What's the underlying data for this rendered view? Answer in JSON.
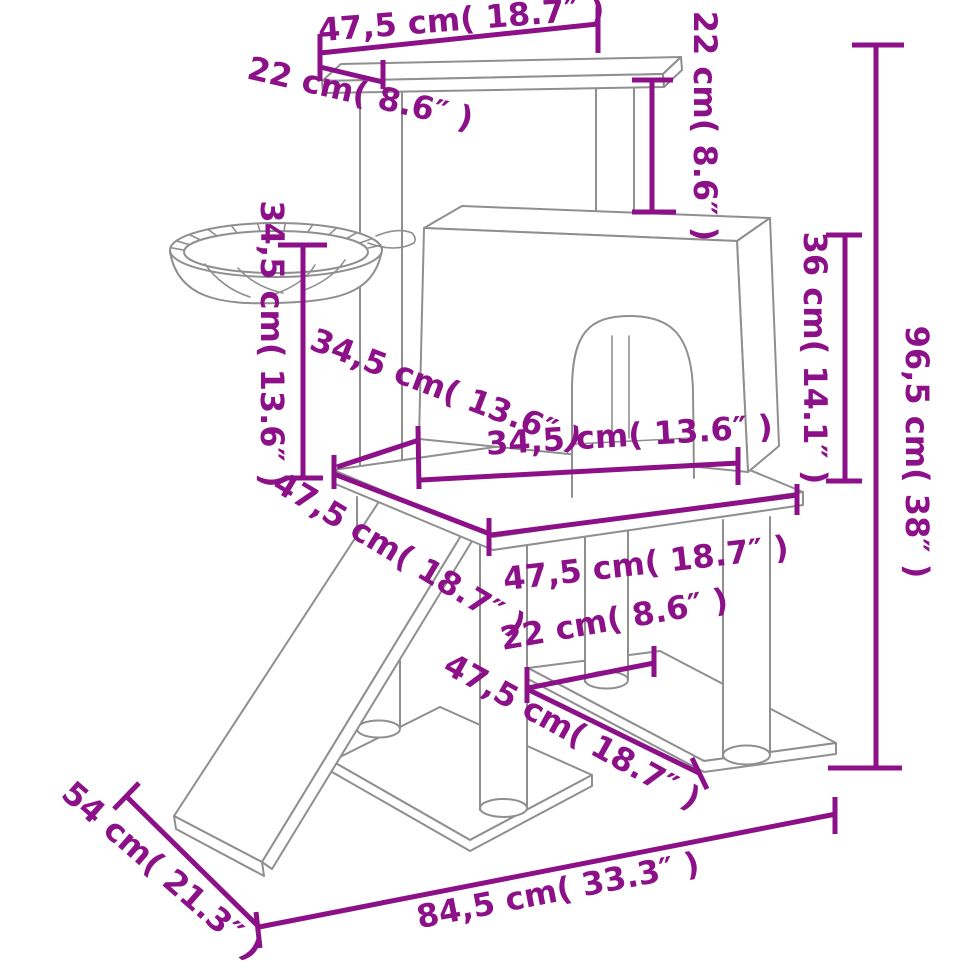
{
  "figure": {
    "type": "product-dimension-diagram",
    "subject": "cat-tree-with-scratching-posts-line-drawing",
    "parts": [
      "top-shelf",
      "support-posts",
      "hammock-basket",
      "cat-house-with-arch-door",
      "middle-platform",
      "ramp",
      "lower-shelf",
      "base-board"
    ]
  },
  "colors": {
    "dimension_lines": "#8c1189",
    "drawing_outline": "#8f8f8f",
    "background": "#ffffff"
  },
  "dimensions": [
    {
      "id": "top-shelf-width",
      "cm": "47,5",
      "inches": "18.7",
      "label": "47,5 cm( 18.7″ )"
    },
    {
      "id": "top-shelf-depth",
      "cm": "22",
      "inches": "8.6",
      "label": "22 cm( 8.6″ )"
    },
    {
      "id": "top-level-height",
      "cm": "22",
      "inches": "8.6",
      "label": "22 cm( 8.6″ )"
    },
    {
      "id": "hammock-height",
      "cm": "34,5",
      "inches": "13.6",
      "label": "34,5 cm( 13.6″ )"
    },
    {
      "id": "house-depth",
      "cm": "34,5",
      "inches": "13.6",
      "label": "34,5 cm( 13.6″ )"
    },
    {
      "id": "house-width",
      "cm": "34,5",
      "inches": "13.6",
      "label": "34,5 cm( 13.6″ )"
    },
    {
      "id": "house-height",
      "cm": "36",
      "inches": "14.1",
      "label": "36 cm( 14.1″ )"
    },
    {
      "id": "total-height",
      "cm": "96,5",
      "inches": "38",
      "label": "96,5 cm( 38″ )"
    },
    {
      "id": "middle-platform-depth",
      "cm": "47,5",
      "inches": "18.7",
      "label": "47,5 cm( 18.7″ )"
    },
    {
      "id": "middle-platform-width",
      "cm": "47,5",
      "inches": "18.7",
      "label": "47,5 cm( 18.7″ )"
    },
    {
      "id": "lower-shelf-width",
      "cm": "22",
      "inches": "8.6",
      "label": "22 cm( 8.6″ )"
    },
    {
      "id": "lower-shelf-depth",
      "cm": "47,5",
      "inches": "18.7",
      "label": "47,5 cm( 18.7″ )"
    },
    {
      "id": "base-overall-width",
      "cm": "84,5",
      "inches": "33.3",
      "label": "84,5 cm( 33.3″ )"
    },
    {
      "id": "base-overall-depth",
      "cm": "54",
      "inches": "21.3",
      "label": "54 cm( 21.3″ )"
    }
  ]
}
